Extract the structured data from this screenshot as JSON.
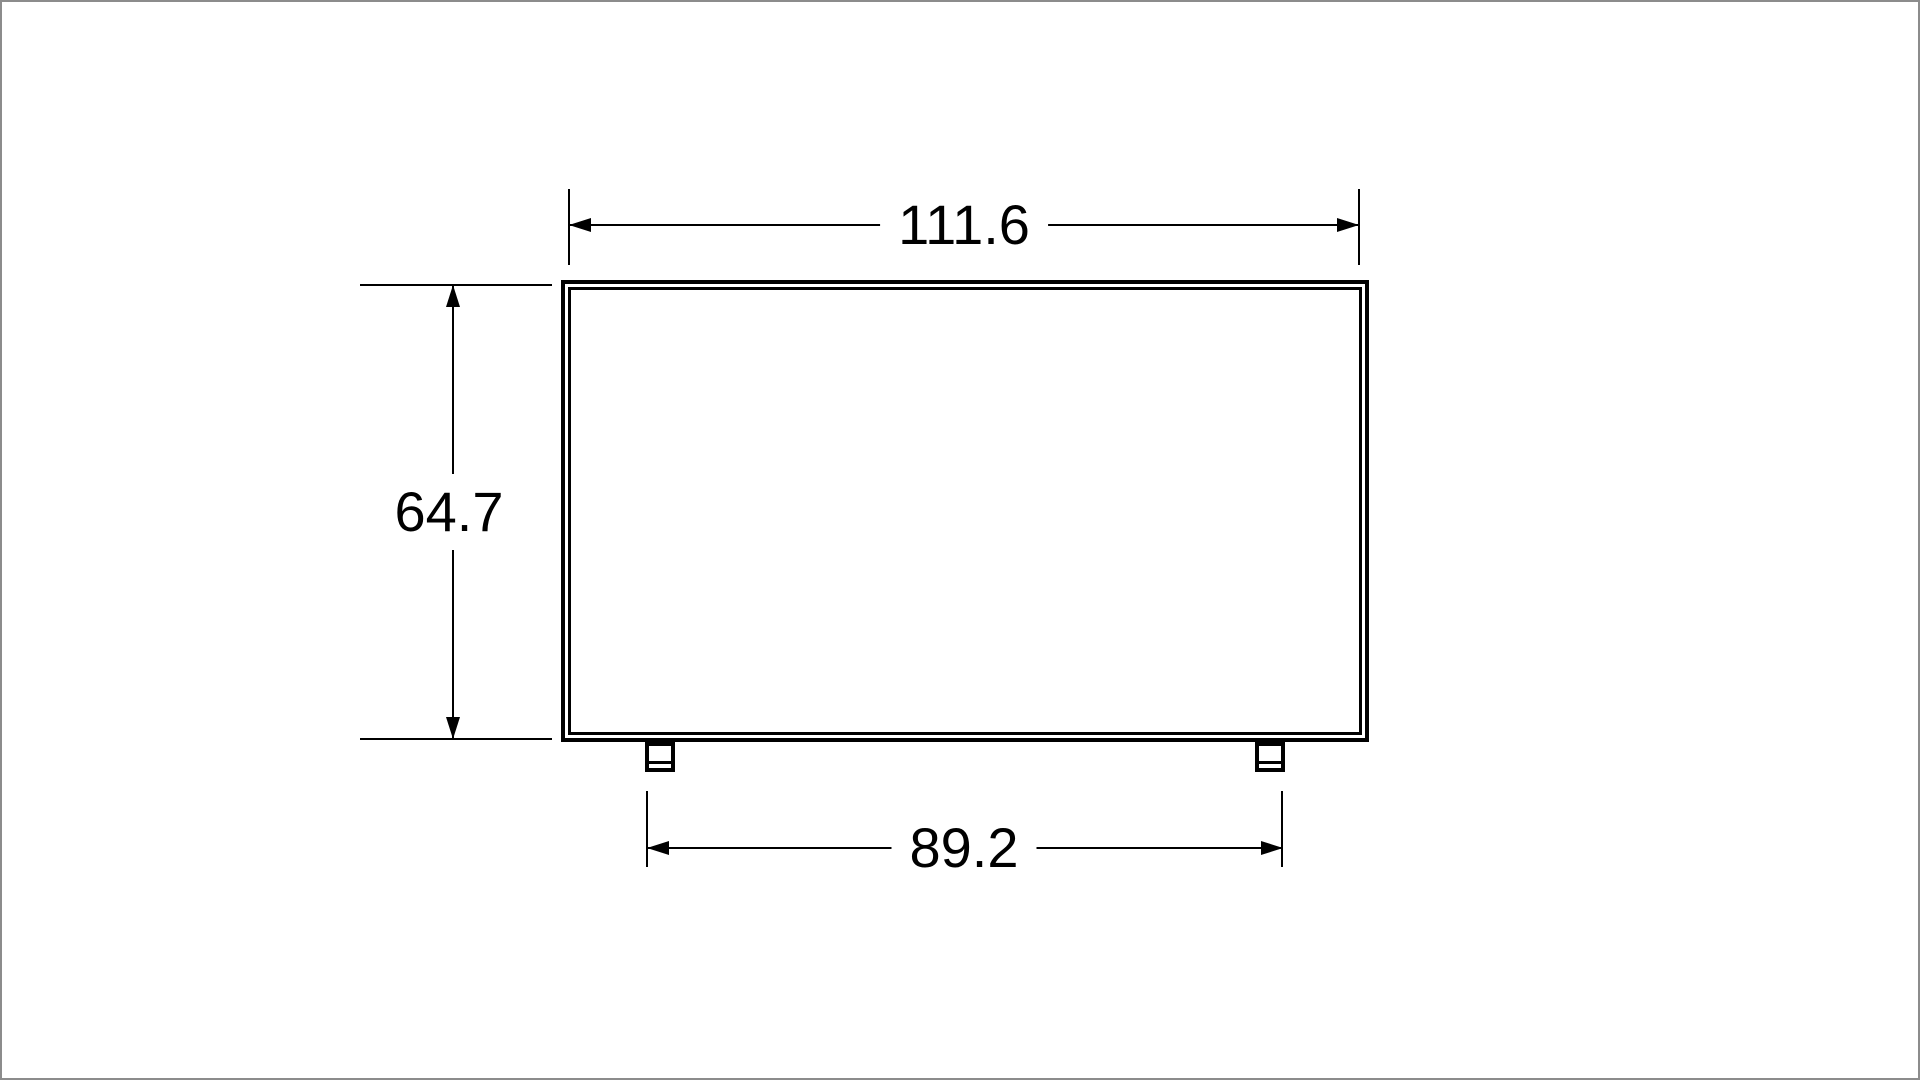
{
  "canvas": {
    "background_color": "#ffffff",
    "frame_color": "#8c8c8c"
  },
  "drawing": {
    "kind": "technical-dimension-drawing",
    "subject": "flat-panel display front view with stand feet",
    "line_color": "#000000",
    "dimensions": {
      "overall_width": {
        "label": "111.6",
        "orientation": "horizontal",
        "position": "top"
      },
      "overall_height": {
        "label": "64.7",
        "orientation": "vertical",
        "position": "left"
      },
      "stand_width": {
        "label": "89.2",
        "orientation": "horizontal",
        "position": "bottom"
      }
    }
  }
}
